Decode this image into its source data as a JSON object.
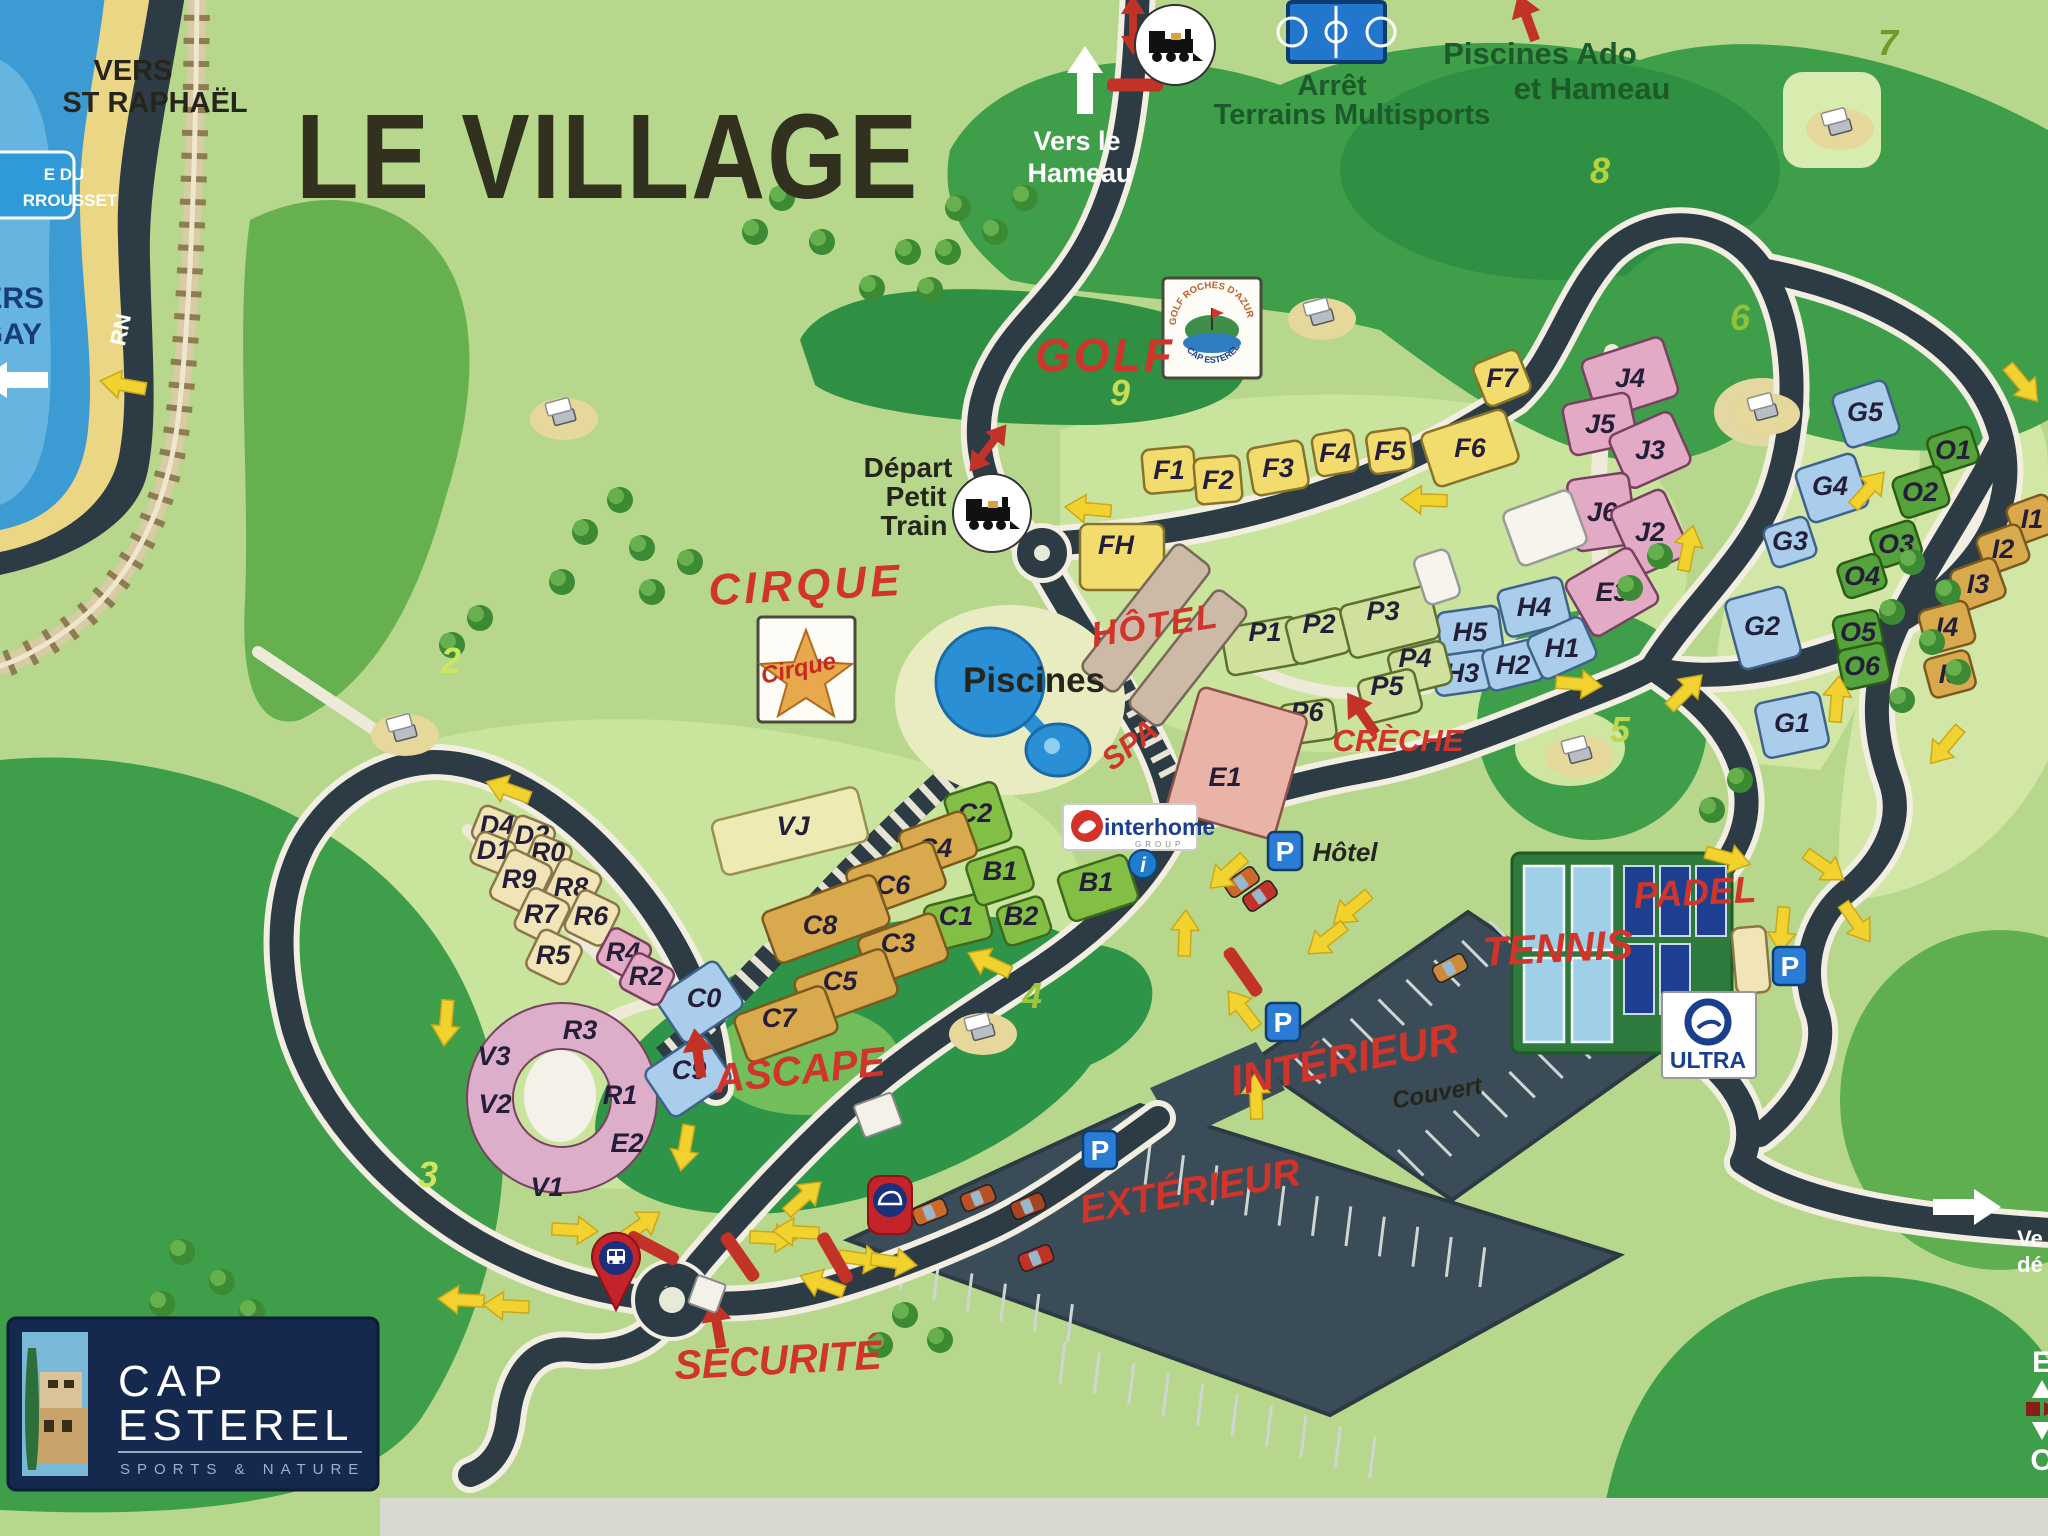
{
  "texts": {
    "le_village": "LE VILLAGE",
    "vers_st_raphael": [
      "VERS",
      "ST RAPHAËL"
    ],
    "vers_le_hameau": [
      "Vers le",
      "Hameau"
    ],
    "arret_multisports": [
      "Arrêt",
      "Terrains Multisports"
    ],
    "piscines_ado": [
      "Piscines Ado",
      "et Hameau"
    ],
    "depart_petit_train": [
      "Départ",
      "Petit",
      "Train"
    ],
    "golf": "GOLF",
    "cirque": "CIRQUE",
    "piscines": "Piscines",
    "hotel": "HÔTEL",
    "spa": "SPA",
    "creche": "CRÈCHE",
    "ascape": "ASCAPE",
    "securite": "SÉCURITÉ",
    "interieur": "INTÉRIEUR",
    "couvert": "Couvert",
    "exterieur": "EXTÉRIEUR",
    "tennis": "TENNIS",
    "padel": "PADEL",
    "parking_hotel": "Hôtel",
    "rn": "RN",
    "sign_coast": [
      "E DU",
      "RROUSSET"
    ],
    "sign_agay": [
      "ERS",
      "GAY"
    ],
    "edge_right": [
      "Ve",
      "dé"
    ],
    "compass": [
      "E",
      "O"
    ]
  },
  "logos": {
    "golf_circle_top": "GOLF ROCHES D'AZUR",
    "golf_circle_bottom": "CAP ESTEREL",
    "cirque": "Cirque",
    "interhome": "interhome",
    "interhome_group": "GROUP",
    "ultra": "ULTRA",
    "cap": [
      "CAP",
      "ESTEREL"
    ],
    "cap_sub": "SPORTS & NATURE",
    "info": "i",
    "parking": "P"
  },
  "holes": [
    {
      "n": "2",
      "x": 451,
      "y": 673,
      "c": "#cce65e"
    },
    {
      "n": "3",
      "x": 428,
      "y": 1187,
      "c": "#cfe55f"
    },
    {
      "n": "4",
      "x": 1032,
      "y": 1008,
      "c": "#9ec73e"
    },
    {
      "n": "5",
      "x": 1620,
      "y": 742,
      "c": "#bed84e"
    },
    {
      "n": "6",
      "x": 1740,
      "y": 330,
      "c": "#8fc23a"
    },
    {
      "n": "7",
      "x": 1888,
      "y": 55,
      "c": "#6f9a28"
    },
    {
      "n": "8",
      "x": 1600,
      "y": 183,
      "c": "#b5d341"
    },
    {
      "n": "9",
      "x": 1120,
      "y": 405,
      "c": "#c6dd52"
    }
  ],
  "buildings": [
    {
      "id": "F1",
      "x": 1169,
      "y": 470,
      "w": 52,
      "h": 44,
      "r": -5,
      "c": "yellow"
    },
    {
      "id": "F2",
      "x": 1218,
      "y": 480,
      "w": 46,
      "h": 46,
      "r": -5,
      "c": "yellow"
    },
    {
      "id": "F3",
      "x": 1278,
      "y": 468,
      "w": 56,
      "h": 48,
      "r": -10,
      "c": "yellow"
    },
    {
      "id": "F4",
      "x": 1335,
      "y": 453,
      "w": 42,
      "h": 42,
      "r": -10,
      "c": "yellow"
    },
    {
      "id": "F5",
      "x": 1390,
      "y": 451,
      "w": 44,
      "h": 42,
      "r": -8,
      "c": "yellow"
    },
    {
      "id": "F6",
      "x": 1470,
      "y": 448,
      "w": 88,
      "h": 56,
      "r": -18,
      "c": "yellow"
    },
    {
      "id": "F7",
      "x": 1502,
      "y": 378,
      "w": 48,
      "h": 46,
      "r": -22,
      "c": "yellow"
    },
    {
      "id": "FH",
      "x": 1122,
      "y": 557,
      "w": 84,
      "h": 66,
      "r": 0,
      "c": "yellow",
      "lx": 1116,
      "ly": 545
    },
    {
      "id": "J4",
      "x": 1630,
      "y": 378,
      "w": 85,
      "h": 62,
      "r": -18,
      "c": "pink"
    },
    {
      "id": "J5",
      "x": 1600,
      "y": 424,
      "w": 68,
      "h": 52,
      "r": -12,
      "c": "pink"
    },
    {
      "id": "J3",
      "x": 1650,
      "y": 450,
      "w": 68,
      "h": 58,
      "r": -24,
      "c": "pink"
    },
    {
      "id": "J6",
      "x": 1602,
      "y": 512,
      "w": 62,
      "h": 72,
      "r": -8,
      "c": "pink"
    },
    {
      "id": "J2",
      "x": 1650,
      "y": 532,
      "w": 58,
      "h": 72,
      "r": -24,
      "c": "pink"
    },
    {
      "id": "E3",
      "x": 1612,
      "y": 592,
      "w": 76,
      "h": 64,
      "r": -30,
      "c": "pink"
    },
    {
      "id": "H5",
      "x": 1470,
      "y": 632,
      "w": 62,
      "h": 46,
      "r": -8,
      "c": "blue"
    },
    {
      "id": "H4",
      "x": 1534,
      "y": 607,
      "w": 66,
      "h": 48,
      "r": -14,
      "c": "blue"
    },
    {
      "id": "H3",
      "x": 1462,
      "y": 673,
      "w": 56,
      "h": 40,
      "r": -8,
      "c": "blue"
    },
    {
      "id": "H2",
      "x": 1513,
      "y": 665,
      "w": 56,
      "h": 42,
      "r": -14,
      "c": "blue"
    },
    {
      "id": "H1",
      "x": 1562,
      "y": 648,
      "w": 60,
      "h": 46,
      "r": -24,
      "c": "blue"
    },
    {
      "id": "P1",
      "x": 1262,
      "y": 646,
      "w": 76,
      "h": 48,
      "r": -10,
      "c": "pgreen",
      "lx": 1265,
      "ly": 632
    },
    {
      "id": "P2",
      "x": 1318,
      "y": 636,
      "w": 58,
      "h": 46,
      "r": -14,
      "c": "pgreen",
      "lx": 1319,
      "ly": 624
    },
    {
      "id": "P3",
      "x": 1390,
      "y": 622,
      "w": 92,
      "h": 54,
      "r": -14,
      "c": "pgreen",
      "lx": 1383,
      "ly": 611
    },
    {
      "id": "P4",
      "x": 1420,
      "y": 668,
      "w": 58,
      "h": 44,
      "r": -14,
      "c": "pgreen",
      "lx": 1415,
      "ly": 658
    },
    {
      "id": "P5",
      "x": 1390,
      "y": 696,
      "w": 58,
      "h": 44,
      "r": -14,
      "c": "pgreen",
      "lx": 1387,
      "ly": 686
    },
    {
      "id": "P6",
      "x": 1308,
      "y": 722,
      "w": 54,
      "h": 40,
      "r": -8,
      "c": "pgreen",
      "lx": 1307,
      "ly": 712
    },
    {
      "id": "E1",
      "x": 1237,
      "y": 763,
      "w": 112,
      "h": 128,
      "r": 16,
      "c": "salmon",
      "lx": 1225,
      "ly": 777
    },
    {
      "id": "C2",
      "x": 978,
      "y": 818,
      "w": 54,
      "h": 62,
      "r": -18,
      "c": "bgreen",
      "lx": 975,
      "ly": 813
    },
    {
      "id": "C1",
      "x": 958,
      "y": 922,
      "w": 62,
      "h": 46,
      "r": -14,
      "c": "bgreen",
      "lx": 956,
      "ly": 916
    },
    {
      "id": "B1",
      "x": 1000,
      "y": 876,
      "w": 60,
      "h": 46,
      "r": -18,
      "c": "bgreen",
      "lx": 1000,
      "ly": 871
    },
    {
      "id": "B1",
      "x": 1098,
      "y": 888,
      "w": 72,
      "h": 50,
      "r": -18,
      "c": "bgreen",
      "lx": 1096,
      "ly": 882
    },
    {
      "id": "B2",
      "x": 1024,
      "y": 921,
      "w": 48,
      "h": 40,
      "r": -18,
      "c": "bgreen",
      "lx": 1021,
      "ly": 916
    },
    {
      "id": "C4",
      "x": 938,
      "y": 844,
      "w": 70,
      "h": 48,
      "r": -20,
      "c": "tan",
      "lx": 935,
      "ly": 848
    },
    {
      "id": "C6",
      "x": 896,
      "y": 879,
      "w": 92,
      "h": 50,
      "r": -20,
      "c": "tan",
      "lx": 893,
      "ly": 885
    },
    {
      "id": "C8",
      "x": 826,
      "y": 919,
      "w": 120,
      "h": 54,
      "r": -20,
      "c": "tan",
      "lx": 820,
      "ly": 925
    },
    {
      "id": "C3",
      "x": 903,
      "y": 949,
      "w": 82,
      "h": 50,
      "r": -20,
      "c": "tan",
      "lx": 898,
      "ly": 943
    },
    {
      "id": "C5",
      "x": 846,
      "y": 987,
      "w": 96,
      "h": 50,
      "r": -20,
      "c": "tan",
      "lx": 840,
      "ly": 981
    },
    {
      "id": "C7",
      "x": 786,
      "y": 1024,
      "w": 96,
      "h": 50,
      "r": -20,
      "c": "tan",
      "lx": 779,
      "ly": 1018
    },
    {
      "id": "C0",
      "x": 700,
      "y": 1002,
      "w": 72,
      "h": 56,
      "r": -34,
      "c": "blue",
      "lx": 704,
      "ly": 998
    },
    {
      "id": "C9",
      "x": 688,
      "y": 1076,
      "w": 72,
      "h": 56,
      "r": -34,
      "c": "blue",
      "lx": 689,
      "ly": 1070
    },
    {
      "id": "VJ",
      "x": 790,
      "y": 831,
      "w": 150,
      "h": 56,
      "r": -14,
      "c": "paleyellow",
      "lx": 793,
      "ly": 826
    },
    {
      "id": "D4",
      "x": 496,
      "y": 828,
      "w": 42,
      "h": 36,
      "r": 22,
      "c": "cream",
      "lx": 497,
      "ly": 825
    },
    {
      "id": "D2",
      "x": 531,
      "y": 838,
      "w": 42,
      "h": 36,
      "r": 22,
      "c": "cream",
      "lx": 532,
      "ly": 835
    },
    {
      "id": "D1",
      "x": 493,
      "y": 853,
      "w": 40,
      "h": 34,
      "r": 22,
      "c": "cream",
      "lx": 494,
      "ly": 850
    },
    {
      "id": "R0",
      "x": 549,
      "y": 856,
      "w": 40,
      "h": 34,
      "r": 22,
      "c": "cream",
      "lx": 548,
      "ly": 852
    },
    {
      "id": "R9",
      "x": 521,
      "y": 882,
      "w": 48,
      "h": 54,
      "r": 26,
      "c": "cream",
      "lx": 519,
      "ly": 879
    },
    {
      "id": "R8",
      "x": 572,
      "y": 889,
      "w": 46,
      "h": 50,
      "r": 26,
      "c": "cream",
      "lx": 571,
      "ly": 887
    },
    {
      "id": "R7",
      "x": 542,
      "y": 916,
      "w": 44,
      "h": 46,
      "r": 26,
      "c": "cream",
      "lx": 541,
      "ly": 914
    },
    {
      "id": "R6",
      "x": 592,
      "y": 918,
      "w": 44,
      "h": 46,
      "r": 26,
      "c": "cream",
      "lx": 591,
      "ly": 916
    },
    {
      "id": "R5",
      "x": 554,
      "y": 957,
      "w": 46,
      "h": 44,
      "r": 26,
      "c": "cream",
      "lx": 553,
      "ly": 955
    },
    {
      "id": "R4",
      "x": 624,
      "y": 954,
      "w": 46,
      "h": 40,
      "r": 28,
      "c": "pink",
      "lx": 623,
      "ly": 952
    },
    {
      "id": "R2",
      "x": 647,
      "y": 979,
      "w": 46,
      "h": 40,
      "r": 28,
      "c": "pink",
      "lx": 646,
      "ly": 976
    },
    {
      "id": "",
      "x": 1545,
      "y": 528,
      "w": 72,
      "h": 58,
      "r": -20,
      "c": "white"
    },
    {
      "id": "",
      "x": 1437,
      "y": 577,
      "w": 36,
      "h": 50,
      "r": -18,
      "c": "white"
    },
    {
      "id": "",
      "x": 1751,
      "y": 960,
      "w": 34,
      "h": 66,
      "r": -5,
      "c": "cream"
    },
    {
      "id": "",
      "x": 1146,
      "y": 618,
      "w": 44,
      "h": 160,
      "r": 38,
      "c": "hotel"
    },
    {
      "id": "",
      "x": 1188,
      "y": 658,
      "w": 40,
      "h": 148,
      "r": 38,
      "c": "hotel"
    },
    {
      "id": "G5",
      "x": 1866,
      "y": 414,
      "w": 56,
      "h": 56,
      "r": -18,
      "c": "blue",
      "lx": 1865,
      "ly": 412
    },
    {
      "id": "G4",
      "x": 1832,
      "y": 488,
      "w": 62,
      "h": 56,
      "r": -18,
      "c": "blue",
      "lx": 1830,
      "ly": 486
    },
    {
      "id": "G3",
      "x": 1790,
      "y": 542,
      "w": 46,
      "h": 42,
      "r": -18,
      "c": "blue",
      "lx": 1790,
      "ly": 541
    },
    {
      "id": "G2",
      "x": 1763,
      "y": 628,
      "w": 62,
      "h": 72,
      "r": -15,
      "c": "blue",
      "lx": 1762,
      "ly": 626
    },
    {
      "id": "G1",
      "x": 1792,
      "y": 725,
      "w": 66,
      "h": 56,
      "r": -12,
      "c": "blue",
      "lx": 1792,
      "ly": 723
    },
    {
      "id": "O1",
      "x": 1953,
      "y": 450,
      "w": 46,
      "h": 38,
      "r": -18,
      "c": "ogreen",
      "lx": 1953,
      "ly": 450
    },
    {
      "id": "O2",
      "x": 1921,
      "y": 492,
      "w": 50,
      "h": 42,
      "r": -18,
      "c": "ogreen",
      "lx": 1920,
      "ly": 492
    },
    {
      "id": "O3",
      "x": 1896,
      "y": 544,
      "w": 46,
      "h": 38,
      "r": -18,
      "c": "ogreen",
      "lx": 1896,
      "ly": 544
    },
    {
      "id": "O4",
      "x": 1862,
      "y": 576,
      "w": 44,
      "h": 36,
      "r": -18,
      "c": "ogreen",
      "lx": 1862,
      "ly": 576
    },
    {
      "id": "O5",
      "x": 1858,
      "y": 632,
      "w": 46,
      "h": 38,
      "r": -12,
      "c": "ogreen",
      "lx": 1858,
      "ly": 632
    },
    {
      "id": "O6",
      "x": 1864,
      "y": 666,
      "w": 48,
      "h": 40,
      "r": -12,
      "c": "ogreen",
      "lx": 1862,
      "ly": 666
    },
    {
      "id": "I1",
      "x": 2032,
      "y": 519,
      "w": 44,
      "h": 40,
      "r": -20,
      "c": "tan",
      "lx": 2032,
      "ly": 519
    },
    {
      "id": "I2",
      "x": 2003,
      "y": 549,
      "w": 46,
      "h": 40,
      "r": -20,
      "c": "tan",
      "lx": 2003,
      "ly": 549
    },
    {
      "id": "I3",
      "x": 1978,
      "y": 584,
      "w": 48,
      "h": 42,
      "r": -20,
      "c": "tan",
      "lx": 1978,
      "ly": 584
    },
    {
      "id": "I4",
      "x": 1947,
      "y": 627,
      "w": 50,
      "h": 44,
      "r": -15,
      "c": "tan",
      "lx": 1947,
      "ly": 627
    },
    {
      "id": "I5",
      "x": 1950,
      "y": 674,
      "w": 46,
      "h": 40,
      "r": -15,
      "c": "tan",
      "lx": 1950,
      "ly": 674
    }
  ],
  "ring_labels": [
    {
      "id": "R3",
      "x": 580,
      "y": 1030
    },
    {
      "id": "V3",
      "x": 494,
      "y": 1056
    },
    {
      "id": "V2",
      "x": 495,
      "y": 1104
    },
    {
      "id": "R1",
      "x": 620,
      "y": 1095
    },
    {
      "id": "E2",
      "x": 627,
      "y": 1143
    },
    {
      "id": "V1",
      "x": 547,
      "y": 1187
    }
  ],
  "arrows": [
    {
      "x": 124,
      "y": 385,
      "r": 190
    },
    {
      "x": 1089,
      "y": 509,
      "r": 185
    },
    {
      "x": 1425,
      "y": 500,
      "r": 182
    },
    {
      "x": 1688,
      "y": 549,
      "r": -78
    },
    {
      "x": 1685,
      "y": 692,
      "r": -45
    },
    {
      "x": 1578,
      "y": 684,
      "r": 5
    },
    {
      "x": 1868,
      "y": 490,
      "r": -48
    },
    {
      "x": 2022,
      "y": 383,
      "r": 50
    },
    {
      "x": 1837,
      "y": 700,
      "r": -85
    },
    {
      "x": 1946,
      "y": 745,
      "r": 130
    },
    {
      "x": 446,
      "y": 1022,
      "r": 95
    },
    {
      "x": 509,
      "y": 790,
      "r": 200
    },
    {
      "x": 990,
      "y": 963,
      "r": 205
    },
    {
      "x": 1228,
      "y": 872,
      "r": 138
    },
    {
      "x": 1352,
      "y": 908,
      "r": 140
    },
    {
      "x": 1327,
      "y": 939,
      "r": 142
    },
    {
      "x": 1185,
      "y": 934,
      "r": -88
    },
    {
      "x": 1243,
      "y": 1010,
      "r": -128
    },
    {
      "x": 1256,
      "y": 1097,
      "r": -92
    },
    {
      "x": 1727,
      "y": 858,
      "r": 15
    },
    {
      "x": 1824,
      "y": 866,
      "r": 35
    },
    {
      "x": 1782,
      "y": 929,
      "r": 95
    },
    {
      "x": 1856,
      "y": 922,
      "r": 55
    },
    {
      "x": 574,
      "y": 1230,
      "r": 3
    },
    {
      "x": 640,
      "y": 1226,
      "r": -35
    },
    {
      "x": 772,
      "y": 1238,
      "r": 3
    },
    {
      "x": 462,
      "y": 1300,
      "r": 183
    },
    {
      "x": 507,
      "y": 1306,
      "r": 183
    },
    {
      "x": 861,
      "y": 1259,
      "r": 8
    },
    {
      "x": 803,
      "y": 1198,
      "r": -42
    },
    {
      "x": 685,
      "y": 1147,
      "r": 100
    },
    {
      "x": 797,
      "y": 1232,
      "r": 183
    },
    {
      "x": 823,
      "y": 1284,
      "r": 200
    },
    {
      "x": 893,
      "y": 1262,
      "r": 8
    }
  ],
  "red_bars": [
    {
      "x": 1135,
      "y": 85,
      "r": 0
    },
    {
      "x": 1243,
      "y": 972,
      "r": 55
    },
    {
      "x": 653,
      "y": 1248,
      "r": 28
    },
    {
      "x": 835,
      "y": 1258,
      "r": 60
    },
    {
      "x": 740,
      "y": 1257,
      "r": 55
    }
  ],
  "red_pointer_arrows": [
    {
      "x": 1527,
      "y": 18,
      "r": -20
    },
    {
      "x": 1362,
      "y": 714,
      "r": -35
    },
    {
      "x": 698,
      "y": 1054,
      "r": -8
    },
    {
      "x": 717,
      "y": 1324,
      "r": -10
    }
  ],
  "red_double_arrows": [
    {
      "x": 1133,
      "y": 25,
      "r": 0
    },
    {
      "x": 988,
      "y": 448,
      "r": 38
    }
  ],
  "white_arrows": [
    {
      "x": 1085,
      "y": 82,
      "r": 0
    },
    {
      "x": 1965,
      "y": 1207,
      "r": 90
    },
    {
      "x": 16,
      "y": 380,
      "r": -90
    }
  ],
  "p_icons": [
    {
      "x": 1285,
      "y": 851
    },
    {
      "x": 1283,
      "y": 1022
    },
    {
      "x": 1100,
      "y": 1150
    },
    {
      "x": 1790,
      "y": 966
    }
  ],
  "cars": [
    {
      "x": 930,
      "y": 1212,
      "r": -22,
      "c": "#cc6a2a"
    },
    {
      "x": 978,
      "y": 1198,
      "r": -22,
      "c": "#b85226"
    },
    {
      "x": 1028,
      "y": 1206,
      "r": -22,
      "c": "#a84422"
    },
    {
      "x": 1036,
      "y": 1258,
      "r": -22,
      "c": "#c23227"
    },
    {
      "x": 1242,
      "y": 882,
      "r": -35,
      "c": "#cc6a2a"
    },
    {
      "x": 1260,
      "y": 896,
      "r": -35,
      "c": "#c23227"
    },
    {
      "x": 1450,
      "y": 968,
      "r": -28,
      "c": "#cc8a3a"
    }
  ],
  "carts": [
    {
      "x": 564,
      "y": 413
    },
    {
      "x": 405,
      "y": 729
    },
    {
      "x": 1322,
      "y": 313
    },
    {
      "x": 1840,
      "y": 123
    },
    {
      "x": 1766,
      "y": 408
    },
    {
      "x": 983,
      "y": 1028
    },
    {
      "x": 1580,
      "y": 751
    }
  ],
  "trees": [
    {
      "x": 958,
      "y": 208
    },
    {
      "x": 995,
      "y": 232
    },
    {
      "x": 948,
      "y": 252
    },
    {
      "x": 1025,
      "y": 198
    },
    {
      "x": 908,
      "y": 252
    },
    {
      "x": 872,
      "y": 288
    },
    {
      "x": 822,
      "y": 242
    },
    {
      "x": 782,
      "y": 198
    },
    {
      "x": 755,
      "y": 232
    },
    {
      "x": 930,
      "y": 290
    },
    {
      "x": 620,
      "y": 500
    },
    {
      "x": 585,
      "y": 532
    },
    {
      "x": 642,
      "y": 548
    },
    {
      "x": 562,
      "y": 582
    },
    {
      "x": 690,
      "y": 562
    },
    {
      "x": 652,
      "y": 592
    },
    {
      "x": 480,
      "y": 618
    },
    {
      "x": 452,
      "y": 645
    },
    {
      "x": 182,
      "y": 1252
    },
    {
      "x": 222,
      "y": 1282
    },
    {
      "x": 162,
      "y": 1304
    },
    {
      "x": 252,
      "y": 1312
    },
    {
      "x": 206,
      "y": 1346
    },
    {
      "x": 282,
      "y": 1345
    },
    {
      "x": 1912,
      "y": 562
    },
    {
      "x": 1948,
      "y": 592
    },
    {
      "x": 1892,
      "y": 612
    },
    {
      "x": 1932,
      "y": 642
    },
    {
      "x": 1958,
      "y": 672
    },
    {
      "x": 1902,
      "y": 700
    },
    {
      "x": 1660,
      "y": 556
    },
    {
      "x": 1630,
      "y": 588
    },
    {
      "x": 905,
      "y": 1315
    },
    {
      "x": 940,
      "y": 1340
    },
    {
      "x": 880,
      "y": 1345
    },
    {
      "x": 1740,
      "y": 780
    },
    {
      "x": 1712,
      "y": 810
    }
  ],
  "stalls": [
    {
      "x": 1150,
      "y": 1145,
      "r": 17,
      "n": 11,
      "gap": 35,
      "len": 40
    },
    {
      "x": 905,
      "y": 1253,
      "r": 17,
      "n": 6,
      "gap": 35,
      "len": 38
    },
    {
      "x": 1065,
      "y": 1342,
      "r": 17,
      "n": 10,
      "gap": 36,
      "len": 42
    },
    {
      "x": 1295,
      "y": 1058,
      "r": -35,
      "n": 8,
      "gap": 34,
      "len": 36
    },
    {
      "x": 1398,
      "y": 1150,
      "r": -35,
      "n": 7,
      "gap": 34,
      "len": 36
    }
  ]
}
